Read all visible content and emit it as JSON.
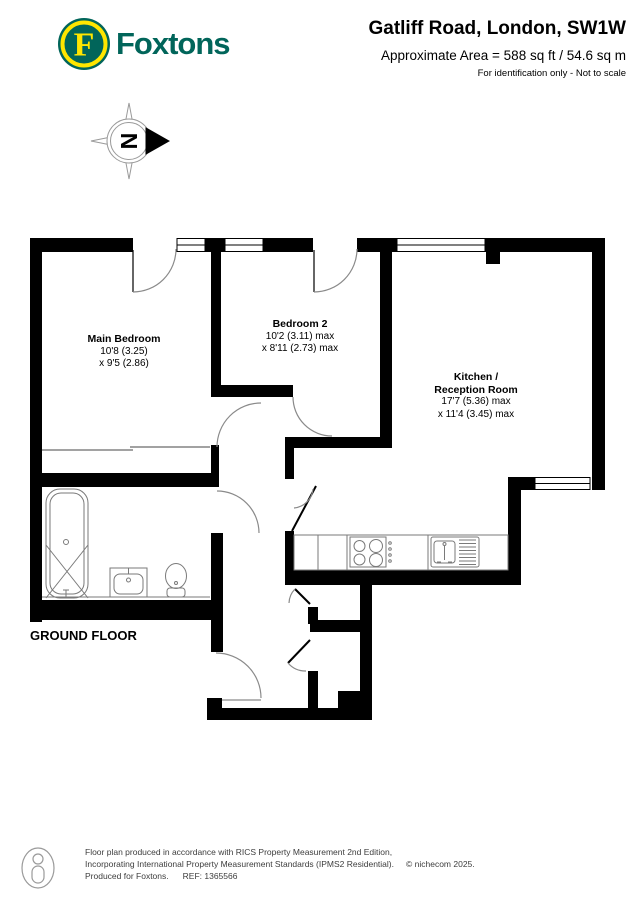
{
  "header": {
    "brand": "Foxtons",
    "logo_letter": "F",
    "title": "Gatliff Road, London, SW1W",
    "area_line": "Approximate Area = 588 sq ft / 54.6 sq m",
    "disclaimer": "For identification only - Not to scale"
  },
  "compass": {
    "letter": "N"
  },
  "floor_label": "GROUND FLOOR",
  "rooms": [
    {
      "name": "Main Bedroom",
      "dim1": "10'8 (3.25)",
      "dim2": "x 9'5 (2.86)"
    },
    {
      "name": "Bedroom 2",
      "dim1": "10'2 (3.11) max",
      "dim2": "x 8'11 (2.73) max"
    },
    {
      "name": "Kitchen /",
      "name2": "Reception Room",
      "dim1": "17'7 (5.36) max",
      "dim2": "x 11'4 (3.45) max"
    }
  ],
  "footer": {
    "line1": "Floor plan produced in accordance with RICS Property Measurement 2nd Edition,",
    "line2": "Incorporating International Property Measurement Standards (IPMS2 Residential).",
    "copyright": "© nichecom 2025.",
    "produced": "Produced for Foxtons.",
    "ref": "REF:  1365566"
  },
  "colors": {
    "brand_green": "#01655a",
    "brand_yellow": "#ffe600",
    "wall_black": "#000000",
    "fixture_gray": "#7a7a7a"
  }
}
